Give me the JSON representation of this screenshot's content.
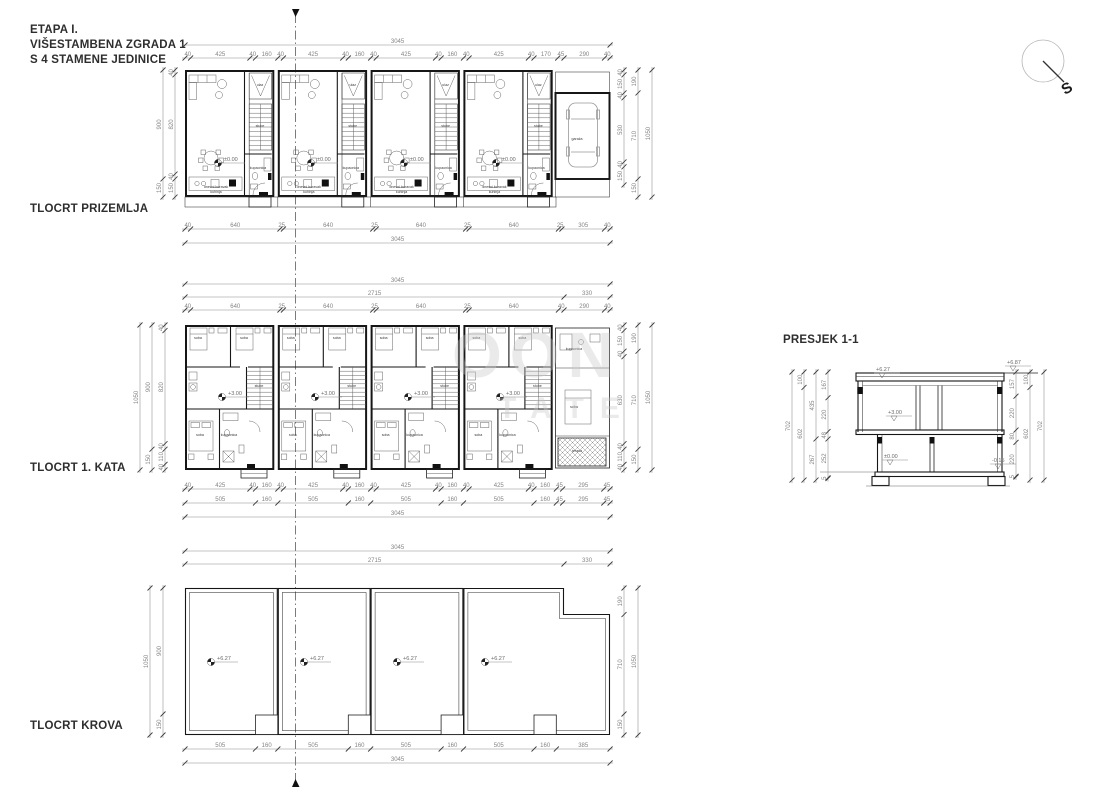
{
  "title": {
    "line1": "ETAPA I.",
    "line2": "VIŠESTAMBENA ZGRADA 1",
    "line3": "S 4 STAMENE JEDINICE"
  },
  "plan_labels": {
    "ground": "TLOCRT PRIZEMLJA",
    "first": "TLOCRT 1. KATA",
    "roof": "TLOCRT KROVA",
    "section": "PRESJEK 1-1"
  },
  "north_label": "S",
  "watermark": {
    "line1": "OON",
    "line2": "TATE"
  },
  "dimension_chains": [
    {
      "d": "h",
      "x": 185,
      "y": 45,
      "s": 0.1396,
      "segs": [
        3045
      ]
    },
    {
      "d": "h",
      "x": 185,
      "y": 58,
      "s": 0.1396,
      "segs": [
        40,
        425,
        40,
        160,
        40,
        425,
        40,
        160,
        40,
        425,
        40,
        160,
        40,
        425,
        40,
        170,
        45,
        290,
        40
      ]
    },
    {
      "d": "h",
      "x": 185,
      "y": 229,
      "s": 0.1396,
      "segs": [
        40,
        640,
        25,
        640,
        25,
        640,
        25,
        640,
        25,
        305,
        40
      ]
    },
    {
      "d": "h",
      "x": 185,
      "y": 243,
      "s": 0.1396,
      "segs": [
        3045
      ]
    },
    {
      "d": "v",
      "x": 163,
      "y": 70,
      "s": 0.121,
      "segs": [
        900,
        150
      ]
    },
    {
      "d": "v",
      "x": 175,
      "y": 70,
      "s": 0.121,
      "segs": [
        40,
        820,
        40,
        150
      ]
    },
    {
      "d": "v",
      "x": 624,
      "y": 70,
      "s": 0.121,
      "segs": [
        40,
        150,
        40,
        530,
        40,
        150
      ]
    },
    {
      "d": "v",
      "x": 638,
      "y": 70,
      "s": 0.121,
      "segs": [
        190,
        710,
        150
      ]
    },
    {
      "d": "v",
      "x": 652,
      "y": 70,
      "s": 0.121,
      "segs": [
        1050
      ]
    },
    {
      "d": "h",
      "x": 185,
      "y": 284,
      "s": 0.1396,
      "segs": [
        3045
      ]
    },
    {
      "d": "h",
      "x": 185,
      "y": 297,
      "s": 0.1396,
      "segs": [
        2715,
        330
      ]
    },
    {
      "d": "h",
      "x": 185,
      "y": 310,
      "s": 0.1396,
      "segs": [
        40,
        640,
        25,
        640,
        25,
        640,
        25,
        640,
        40,
        290,
        40
      ]
    },
    {
      "d": "h",
      "x": 185,
      "y": 489,
      "s": 0.1396,
      "segs": [
        40,
        425,
        40,
        160,
        40,
        425,
        40,
        160,
        40,
        425,
        40,
        160,
        40,
        425,
        40,
        160,
        45,
        295,
        45
      ]
    },
    {
      "d": "h",
      "x": 185,
      "y": 503,
      "s": 0.1396,
      "segs": [
        505,
        160,
        505,
        160,
        505,
        160,
        505,
        160,
        45,
        295,
        45
      ]
    },
    {
      "d": "h",
      "x": 185,
      "y": 517,
      "s": 0.1396,
      "segs": [
        3045
      ]
    },
    {
      "d": "v",
      "x": 140,
      "y": 325,
      "s": 0.138,
      "segs": [
        1050
      ]
    },
    {
      "d": "v",
      "x": 152,
      "y": 325,
      "s": 0.138,
      "segs": [
        900,
        150
      ]
    },
    {
      "d": "v",
      "x": 165,
      "y": 325,
      "s": 0.138,
      "segs": [
        40,
        820,
        40,
        110,
        40
      ]
    },
    {
      "d": "v",
      "x": 624,
      "y": 325,
      "s": 0.138,
      "segs": [
        40,
        150,
        40,
        630,
        40,
        110,
        40
      ]
    },
    {
      "d": "v",
      "x": 638,
      "y": 325,
      "s": 0.138,
      "segs": [
        190,
        710,
        150
      ]
    },
    {
      "d": "v",
      "x": 652,
      "y": 325,
      "s": 0.138,
      "segs": [
        1050
      ]
    },
    {
      "d": "h",
      "x": 185,
      "y": 551,
      "s": 0.1396,
      "segs": [
        3045
      ]
    },
    {
      "d": "h",
      "x": 185,
      "y": 564,
      "s": 0.1396,
      "segs": [
        2715,
        330
      ]
    },
    {
      "d": "h",
      "x": 185,
      "y": 749,
      "s": 0.1396,
      "segs": [
        505,
        160,
        505,
        160,
        505,
        160,
        505,
        160,
        385
      ]
    },
    {
      "d": "h",
      "x": 185,
      "y": 763,
      "s": 0.1396,
      "segs": [
        3045
      ]
    },
    {
      "d": "v",
      "x": 163,
      "y": 588,
      "s": 0.14,
      "segs": [
        900,
        150
      ]
    },
    {
      "d": "v",
      "x": 150,
      "y": 588,
      "s": 0.14,
      "segs": [
        1050
      ]
    },
    {
      "d": "v",
      "x": 624,
      "y": 588,
      "s": 0.14,
      "segs": [
        190,
        710,
        150
      ]
    },
    {
      "d": "v",
      "x": 638,
      "y": 588,
      "s": 0.14,
      "segs": [
        1050
      ]
    },
    {
      "d": "v",
      "x": 792,
      "y": 372,
      "s": 0.154,
      "segs": [
        702
      ]
    },
    {
      "d": "v",
      "x": 804,
      "y": 372,
      "s": 0.154,
      "segs": [
        100,
        602
      ]
    },
    {
      "d": "v",
      "x": 816,
      "y": 372,
      "s": 0.154,
      "segs": [
        435,
        267
      ]
    },
    {
      "d": "v",
      "x": 828,
      "y": 372,
      "s": 0.154,
      "segs": [
        167,
        220,
        48,
        252,
        5
      ]
    },
    {
      "d": "v",
      "x": 1016,
      "y": 372,
      "s": 0.154,
      "segs": [
        157,
        220,
        80,
        220,
        5
      ]
    },
    {
      "d": "v",
      "x": 1030,
      "y": 372,
      "s": 0.154,
      "segs": [
        100,
        602
      ]
    },
    {
      "d": "v",
      "x": 1044,
      "y": 372,
      "s": 0.154,
      "segs": [
        702
      ]
    }
  ],
  "section_levels": [
    {
      "text": "+6.27",
      "x": 876,
      "y": 371
    },
    {
      "text": "+6.87",
      "x": 1007,
      "y": 364
    },
    {
      "text": "+3.00",
      "x": 888,
      "y": 414
    },
    {
      "text": "±0.00",
      "x": 884,
      "y": 458
    },
    {
      "text": "-0.15",
      "x": 992,
      "y": 462
    }
  ],
  "plan_level_markers": [
    {
      "text": "±0.00",
      "y": 163,
      "xs": [
        225,
        318,
        411,
        503
      ]
    },
    {
      "text": "+3.00",
      "y": 397,
      "xs": [
        229,
        322,
        415,
        507
      ]
    },
    {
      "text": "+6.27",
      "y": 662,
      "xs": [
        218,
        311,
        404,
        492
      ]
    }
  ],
  "room_labels": {
    "gf_unit": [
      {
        "t": "dnevni boravak",
        "dx": 31,
        "dy": 118
      },
      {
        "t": "kuhinja",
        "dx": 31,
        "dy": 123
      },
      {
        "t": "ulaz",
        "dx": 75,
        "dy": 16
      },
      {
        "t": "stube",
        "dx": 75,
        "dy": 57
      },
      {
        "t": "kupaonica",
        "dx": 73,
        "dy": 99
      }
    ],
    "ff_unit": [
      {
        "t": "soba",
        "dx": 13,
        "dy": 14
      },
      {
        "t": "soba",
        "dx": 59,
        "dy": 14
      },
      {
        "t": "stube",
        "dx": 74,
        "dy": 62
      },
      {
        "t": "soba",
        "dx": 15,
        "dy": 111
      },
      {
        "t": "kupaonica",
        "dx": 44,
        "dy": 111
      }
    ],
    "singles": [
      {
        "t": "garaža",
        "x": 577,
        "y": 140
      },
      {
        "t": "kupaonica",
        "x": 574,
        "y": 350
      },
      {
        "t": "soba",
        "x": 574,
        "y": 408
      },
      {
        "t": "terasa",
        "x": 577,
        "y": 452
      }
    ]
  }
}
